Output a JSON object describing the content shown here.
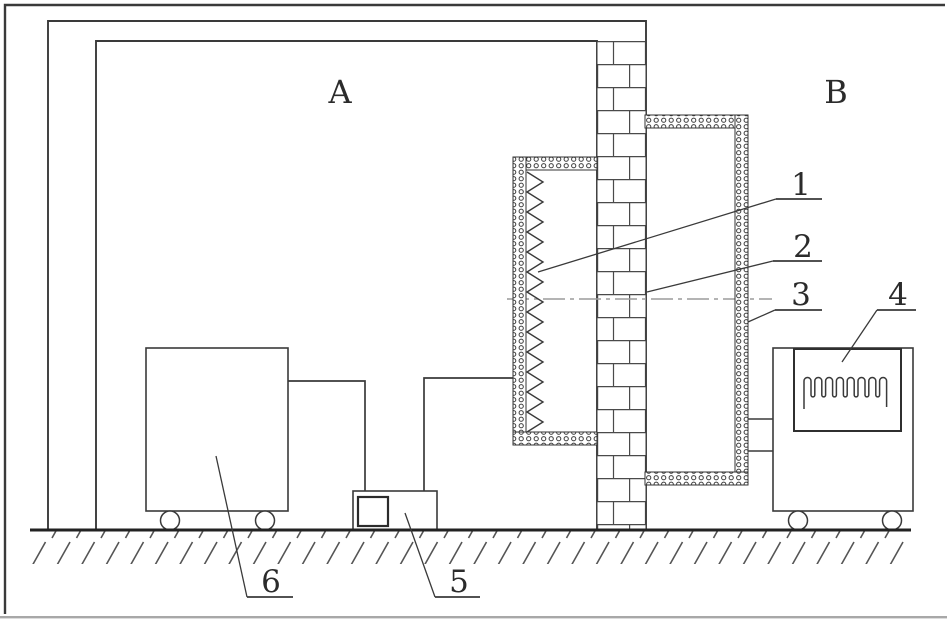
{
  "labels": {
    "room_a": "A",
    "room_b": "B",
    "callout_1": "1",
    "callout_2": "2",
    "callout_3": "3",
    "callout_4": "4",
    "callout_5": "5",
    "callout_6": "6"
  },
  "colors": {
    "line": "#3a3a3a",
    "centerline": "#9c9c9c",
    "background": "#ffffff"
  }
}
